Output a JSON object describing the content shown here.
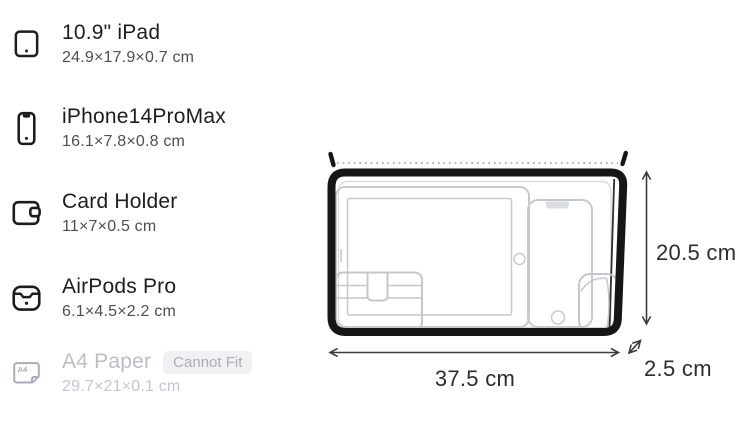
{
  "colors": {
    "title_text": "#1d1d1f",
    "subtitle_text": "#4d4e52",
    "disabled_text": "#b9bec7",
    "badge_background": "#f1f1f4",
    "badge_text": "#a9aeb9",
    "outline_gray": "#c6cace",
    "bag_black": "#161616"
  },
  "items": [
    {
      "icon": "tablet-icon",
      "name": "10.9\" iPad",
      "dimensions": "24.9×17.9×0.7 cm",
      "fits": true
    },
    {
      "icon": "smartphone-icon",
      "name": "iPhone14ProMax",
      "dimensions": "16.1×7.8×0.8 cm",
      "fits": true
    },
    {
      "icon": "wallet-icon",
      "name": "Card Holder",
      "dimensions": "11×7×0.5 cm",
      "fits": true
    },
    {
      "icon": "earbuds-case-icon",
      "name": "AirPods Pro",
      "dimensions": "6.1×4.5×2.2 cm",
      "fits": true
    },
    {
      "icon": "a4-paper-icon",
      "icon_label": "A4",
      "name": "A4 Paper",
      "badge": "Cannot Fit",
      "dimensions": "29.7×21×0.1 cm",
      "fits": false
    }
  ],
  "diagram": {
    "width_label": "37.5 cm",
    "height_label": "20.5 cm",
    "depth_label": "2.5 cm"
  }
}
